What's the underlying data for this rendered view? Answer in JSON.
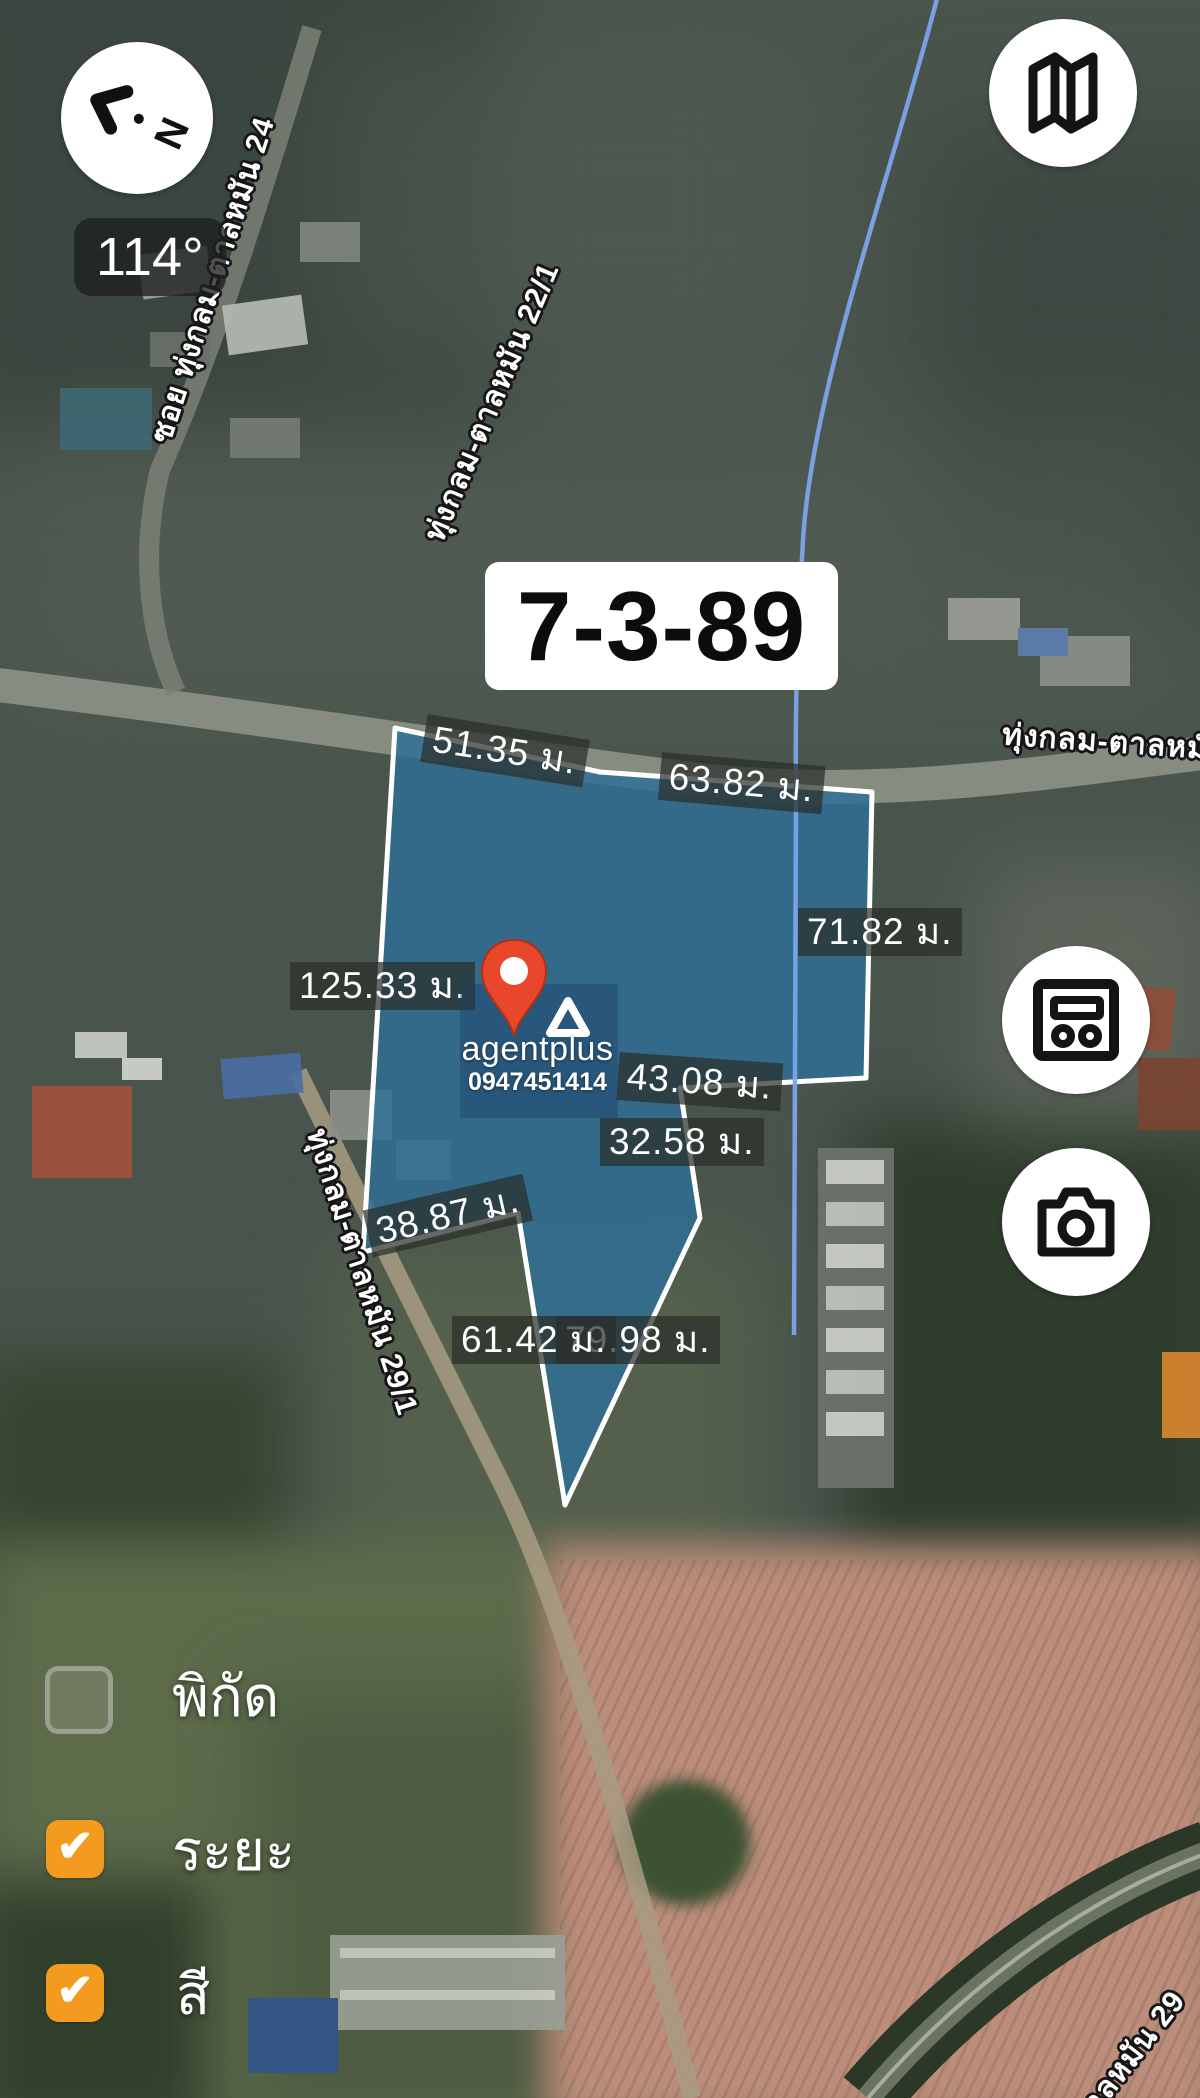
{
  "area_box": {
    "value": "7-3-89"
  },
  "compass": {
    "bearing": "114°",
    "needle_label": "N"
  },
  "measurements": [
    {
      "text": "51.35 ม."
    },
    {
      "text": "63.82 ม."
    },
    {
      "text": "71.82 ม."
    },
    {
      "text": "125.33 ม."
    },
    {
      "text": "43.08 ม."
    },
    {
      "text": "32.58 ม."
    },
    {
      "text": "38.87 ม."
    },
    {
      "text": "61.42 ม."
    },
    {
      "text": "79.98 ม."
    }
  ],
  "roads": [
    {
      "name": "ซอย ทุ่งกลม-ตาลหมัน 24"
    },
    {
      "name": "ทุ่งกลม-ตาลหมัน 22/1"
    },
    {
      "name": "ทุ่งกลม-ตาลหมั"
    },
    {
      "name": "ทุ่งกลม-ตาลหมัน 29/1"
    },
    {
      "name": "ตาลหมัน 29"
    }
  ],
  "watermark": {
    "brand": "agentplus",
    "phone": "0947451414"
  },
  "controls": {
    "checkboxes": [
      {
        "label": "พิกัด",
        "checked": false
      },
      {
        "label": "ระยะ",
        "checked": true
      },
      {
        "label": "สี",
        "checked": true
      }
    ],
    "check_glyph": "✔"
  },
  "icons": {
    "compass": "compass-needle",
    "map": "folded-map",
    "cards": "card-panel",
    "camera": "camera"
  },
  "colors": {
    "plot_fill": "#2e6f97",
    "plot_stroke": "#ffffff",
    "stream": "#7da4ea",
    "checkbox_checked": "#f39b1f",
    "label_bg": "rgba(42,47,42,0.72)",
    "pin": "#e8472b"
  }
}
